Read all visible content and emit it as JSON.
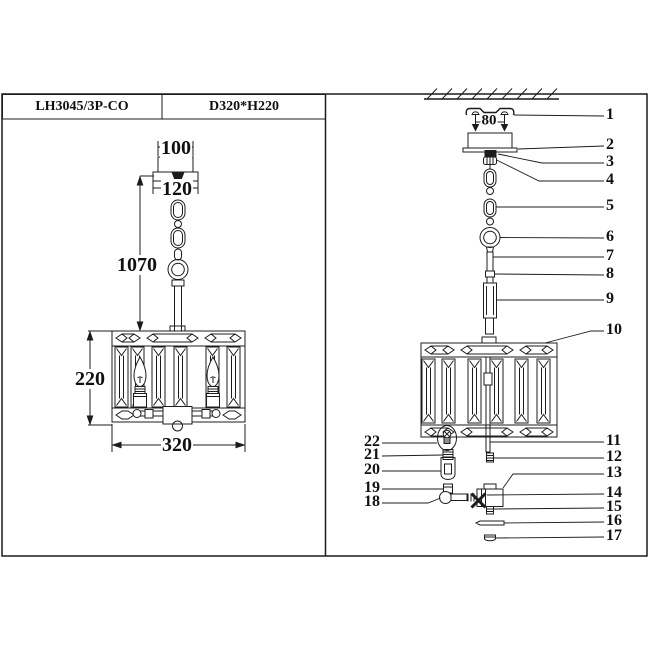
{
  "title_block": {
    "model": "LH3045/3P-CO",
    "size": "D320*H220"
  },
  "dimensions": {
    "canopy_top_width": "100",
    "canopy_base_width": "120",
    "overall_drop": "1070",
    "shade_height": "220",
    "shade_width": "320",
    "bracket_screw_spacing": "80"
  },
  "callouts": {
    "right": [
      "1",
      "2",
      "3",
      "4",
      "5",
      "6",
      "7",
      "8",
      "9",
      "10",
      "11",
      "12",
      "13",
      "14",
      "15",
      "16",
      "17"
    ],
    "left": [
      "22",
      "21",
      "20",
      "19",
      "18"
    ]
  }
}
